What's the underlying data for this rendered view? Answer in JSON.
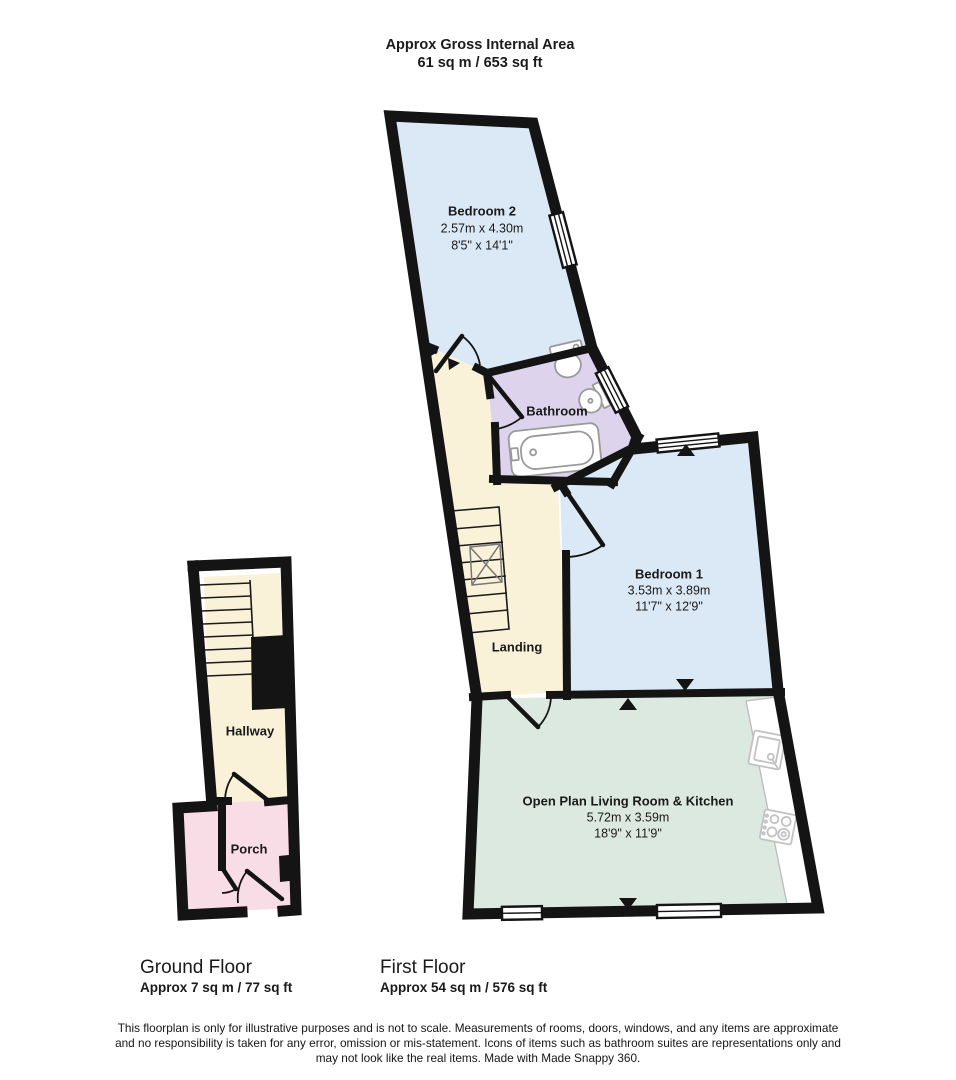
{
  "header": {
    "title": "Approx Gross Internal Area",
    "area": "61 sq m / 653 sq ft"
  },
  "first_floor": {
    "label": "First Floor",
    "area_label": "Approx 54 sq m / 576 sq ft",
    "rooms": {
      "bedroom2": {
        "name": "Bedroom 2",
        "metric": "2.57m x 4.30m",
        "imperial": "8'5\" x 14'1\""
      },
      "bathroom": {
        "name": "Bathroom"
      },
      "landing": {
        "name": "Landing"
      },
      "bedroom1": {
        "name": "Bedroom 1",
        "metric": "3.53m x 3.89m",
        "imperial": "11'7\" x 12'9\""
      },
      "living_kitchen": {
        "name": "Open Plan Living Room & Kitchen",
        "metric": "5.72m x 3.59m",
        "imperial": "18'9\" x 11'9\""
      }
    }
  },
  "ground_floor": {
    "label": "Ground Floor",
    "area_label": "Approx 7 sq m / 77 sq ft",
    "rooms": {
      "hallway": {
        "name": "Hallway"
      },
      "porch": {
        "name": "Porch"
      }
    }
  },
  "footer": {
    "disclaimer_lines": [
      "This floorplan is only for illustrative purposes and is not to scale. Measurements of rooms, doors, windows, and any items are approximate",
      "and no responsibility is taken for any error, omission or mis-statement. Icons of items such as bathroom suites are representations only and",
      "may not look like the real items. Made with Made Snappy 360."
    ]
  },
  "colors": {
    "bedroom": "#dbe8f5",
    "bathroom": "#ddd3ec",
    "hall": "#faf1d9",
    "living": "#dbe9e1",
    "porch": "#f9dde6",
    "wall": "#141414"
  }
}
